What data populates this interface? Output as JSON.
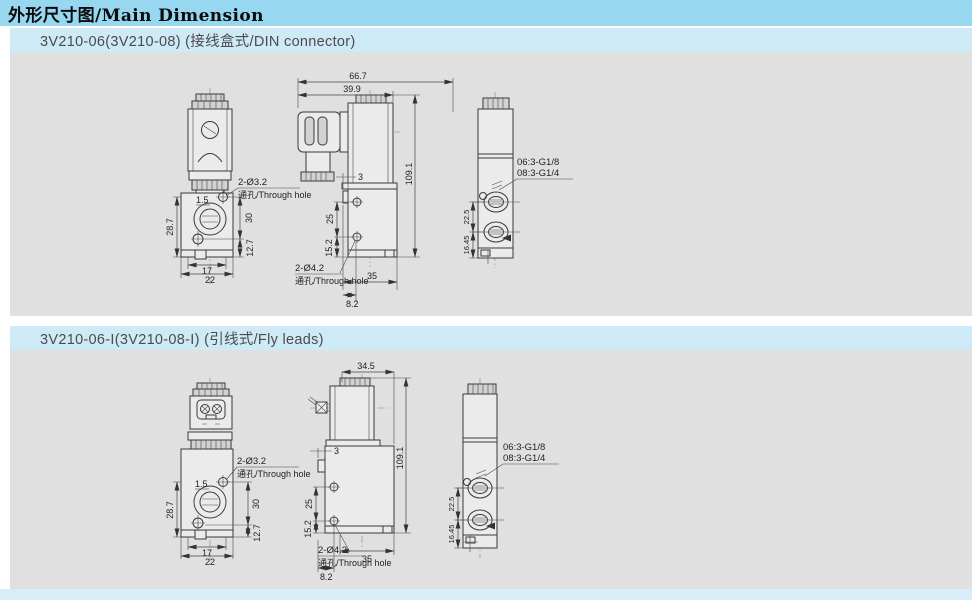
{
  "page": {
    "title": "外形尺寸图/Main Dimension"
  },
  "colors": {
    "title_bar": "#97d7f0",
    "section_header": "#cfeaf7",
    "panel": "#e0e0e0",
    "footer": "#d7edf7",
    "line": "#3a3a3a"
  },
  "sections": [
    {
      "header": "3V210-06(3V210-08)  (接线盒式/DIN connector)",
      "front": {
        "note_size": "2-Ø3.2",
        "note_text": "通孔/Through hole",
        "offset": "1.5",
        "height": "28.7",
        "span_upper": "30",
        "span_lower": "12.7",
        "width_inner": "17",
        "width_outer": "22"
      },
      "side": {
        "top": "66.7",
        "top2": "39.9",
        "total_height": "109.1",
        "tab": "3",
        "hole_span": "25",
        "hole_bottom": "15.2",
        "note_size": "2-Ø4.2",
        "note_text": "通孔/Through hole",
        "bottom_width": "35",
        "bottom_offset": "8.2"
      },
      "end": {
        "port1": "06:3-G1/8",
        "port2": "08:3-G1/4",
        "port_span": "22.5",
        "port_bottom": "16.45"
      }
    },
    {
      "header": "3V210-06-I(3V210-08-I)  (引线式/Fly leads)",
      "front": {
        "note_size": "2-Ø3.2",
        "note_text": "通孔/Through hole",
        "offset": "1.5",
        "height": "28.7",
        "span_upper": "30",
        "span_lower": "12.7",
        "width_inner": "17",
        "width_outer": "22"
      },
      "side": {
        "top": "34.5",
        "total_height": "109.1",
        "tab": "3",
        "hole_span": "25",
        "hole_bottom": "15.2",
        "note_size": "2-Ø4.2",
        "note_text": "通孔/Through hole",
        "bottom_width": "35",
        "bottom_offset": "8.2"
      },
      "end": {
        "port1": "06:3-G1/8",
        "port2": "08:3-G1/4",
        "port_span": "22.5",
        "port_bottom": "16.45"
      }
    }
  ]
}
